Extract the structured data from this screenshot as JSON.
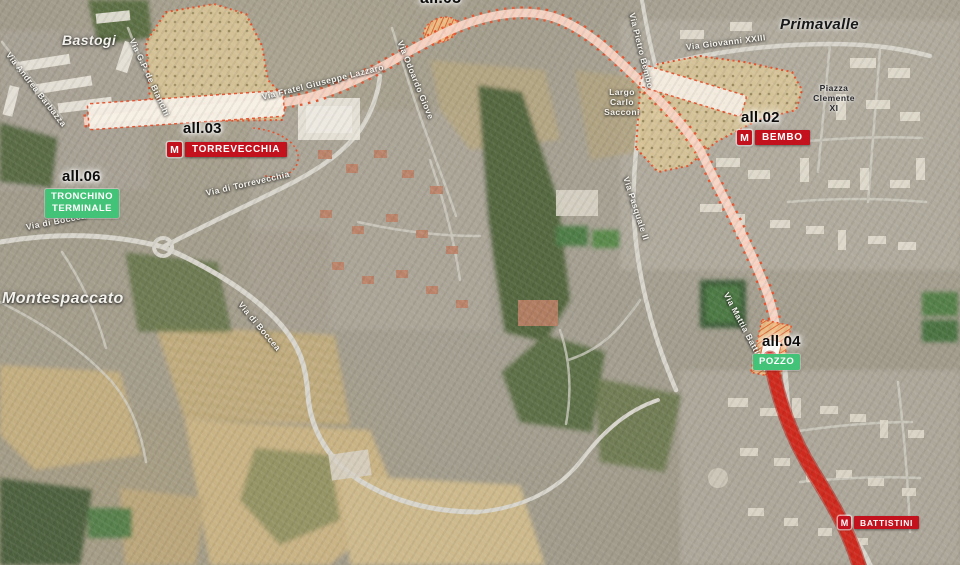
{
  "regions": {
    "bastogi": "Bastogi",
    "primavalle": "Primavalle",
    "montespaccato": "Montespaccato"
  },
  "callouts": {
    "a05": {
      "id": "all.05"
    },
    "a03": {
      "id": "all.03",
      "metro_letter": "M",
      "name": "TORREVECCHIA"
    },
    "a06": {
      "id": "all.06",
      "line1": "TRONCHINO",
      "line2": "TERMINALE"
    },
    "a02": {
      "id": "all.02",
      "metro_letter": "M",
      "name": "BEMBO"
    },
    "a04": {
      "id": "all.04",
      "name": "POZZO"
    },
    "battistini": {
      "metro_letter": "M",
      "name": "BATTISTINI"
    }
  },
  "streets": {
    "barbazza": "Via Andrea Barbazza",
    "bianchi": "Via G.P. de Bianchi",
    "lazzaro": "Via Fratel Giuseppe Lazzaro",
    "giove": "Via Odoardo Giove",
    "torrevecchia": "Via di Torrevecchia",
    "boccea_w": "Via di Boccea",
    "boccea_s": "Via di Boccea",
    "bembo": "Via Pietro Bembo",
    "giovanni": "Via Giovanni XXIII",
    "pasquale": "Via Pasquale II",
    "mattia_battistini": "Via Mattia Battistini",
    "clemente": {
      "l1": "Piazza",
      "l2": "Clemente",
      "l3": "XI"
    },
    "sacconi": {
      "l1": "Largo",
      "l2": "Carlo",
      "l3": "Sacconi"
    }
  },
  "colors": {
    "route_dash": "#e8502a",
    "route_fill": "#f8d5c5",
    "metro_solid": "#cf2a1e",
    "metro_badge_red": "#c3111d",
    "site_badge_green": "#43c377"
  }
}
